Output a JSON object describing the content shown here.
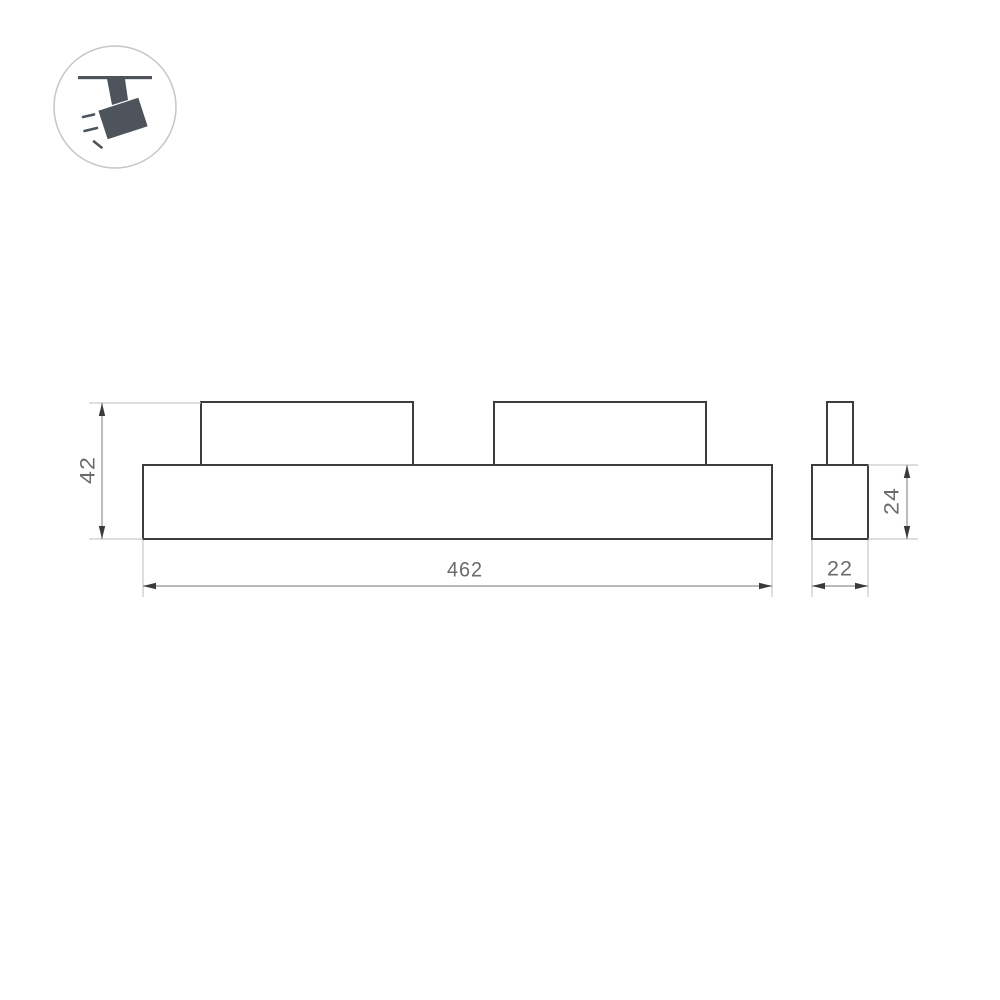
{
  "icon": {
    "name": "ceiling-track-spotlight-icon",
    "description": "magnetic track spotlight hanging from ceiling track with light rays"
  },
  "views": {
    "front": {
      "name": "front-view",
      "parts": [
        "housing",
        "mount-bracket-left",
        "mount-bracket-right"
      ]
    },
    "side": {
      "name": "side-view",
      "parts": [
        "housing",
        "mount-stem"
      ]
    }
  },
  "dimensions": {
    "height": {
      "label": "42",
      "orientation": "vertical"
    },
    "length": {
      "label": "462",
      "orientation": "horizontal"
    },
    "side_height": {
      "label": "24",
      "orientation": "vertical"
    },
    "side_width": {
      "label": "22",
      "orientation": "horizontal"
    }
  },
  "colors": {
    "background": "#ffffff",
    "drawing_fill": "#ffffff",
    "outline": "#3d3d3d",
    "dim_line": "#8f8f8f",
    "ext_line": "#c9c9c9",
    "arrow": "#3a3a3a",
    "dim_text": "#6b6b6b",
    "icon_glyph": "#4e545b",
    "icon_border": "#c6c6c6"
  }
}
